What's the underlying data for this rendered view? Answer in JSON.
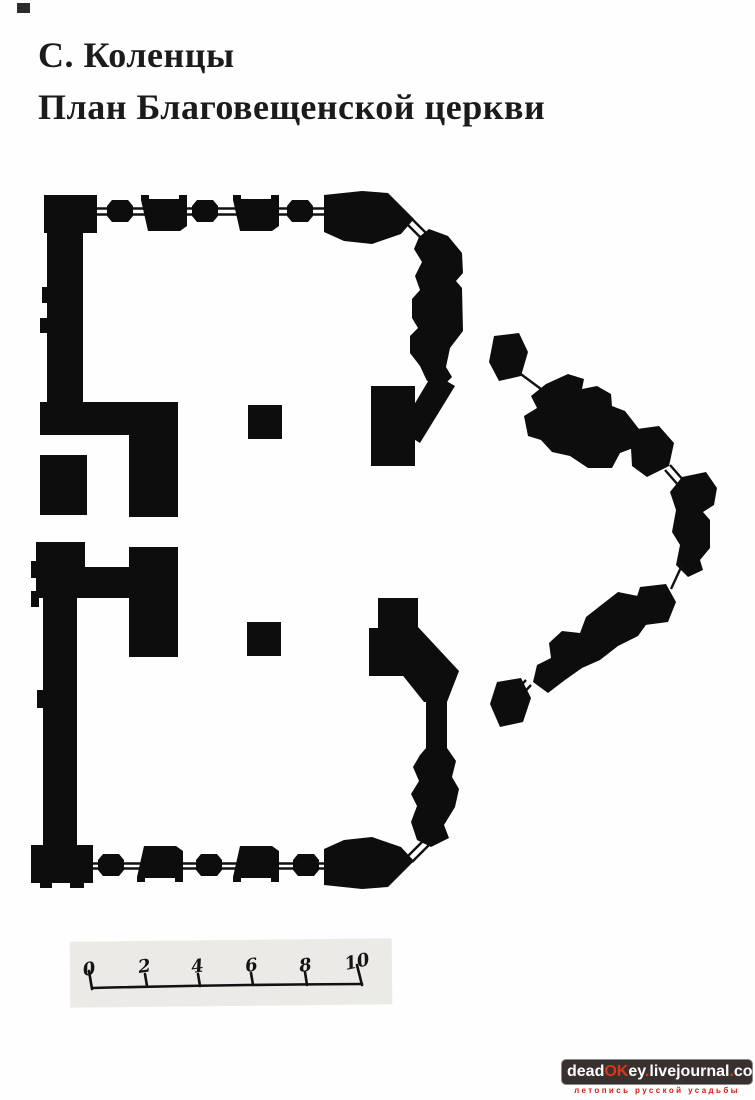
{
  "title": {
    "line1": "С. Коленцы",
    "line2": "План Благовещенской церкви"
  },
  "plan": {
    "ink_color": "#0d0d0d",
    "subject": "floor-plan-of-annunciation-church"
  },
  "scale_bar": {
    "labels": [
      "0",
      "2",
      "4",
      "6",
      "8",
      "10"
    ]
  },
  "watermark": {
    "bar_color": "#37322f",
    "accent_color": "#e03418",
    "tagline_color": "#d31d10",
    "url": {
      "p1": "dead",
      "p2": "OK",
      "p3": "ey",
      "d1": ".",
      "p4": "livejournal",
      "d2": ".",
      "p5": "com"
    },
    "tagline": "летопись русской усадьбы"
  }
}
